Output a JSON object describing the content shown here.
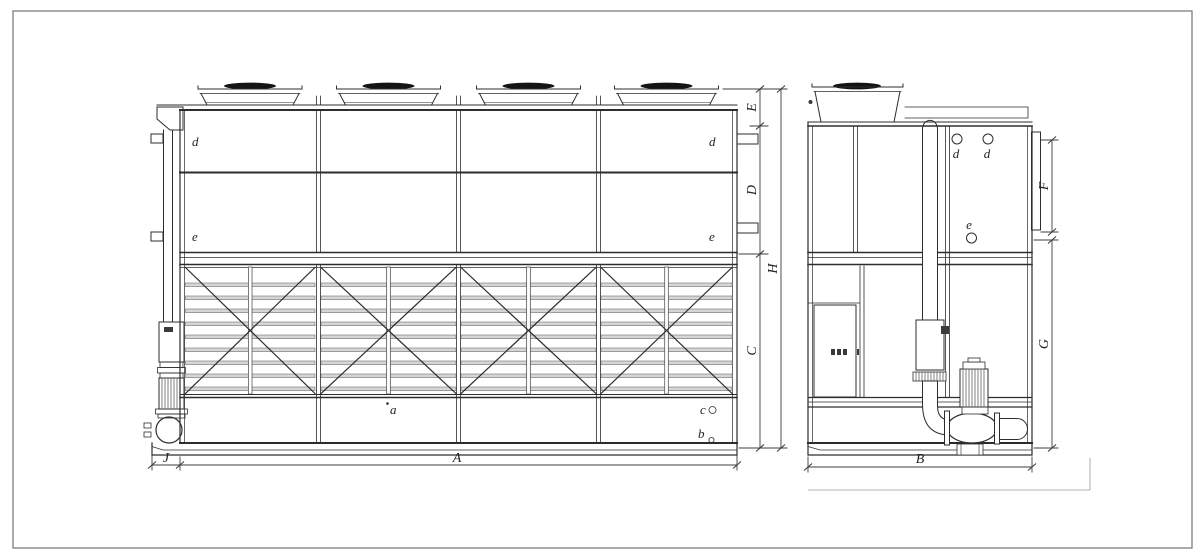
{
  "labels": {
    "A": "A",
    "B": "B",
    "C": "C",
    "D": "D",
    "E": "E",
    "F": "F",
    "G": "G",
    "H": "H",
    "J": "J",
    "a": "a",
    "b": "b",
    "c": "c",
    "d": "d",
    "e": "e"
  },
  "colors": {
    "line": "#2d2d2d",
    "dim_line": "#3c3c3c",
    "slat_fill": "#d6d6d6",
    "fan_cap": "#141414",
    "frame": "#7d7d7d",
    "aux_line": "#9a9a9a",
    "mark": "#3a3a3a",
    "background": "#ffffff"
  }
}
